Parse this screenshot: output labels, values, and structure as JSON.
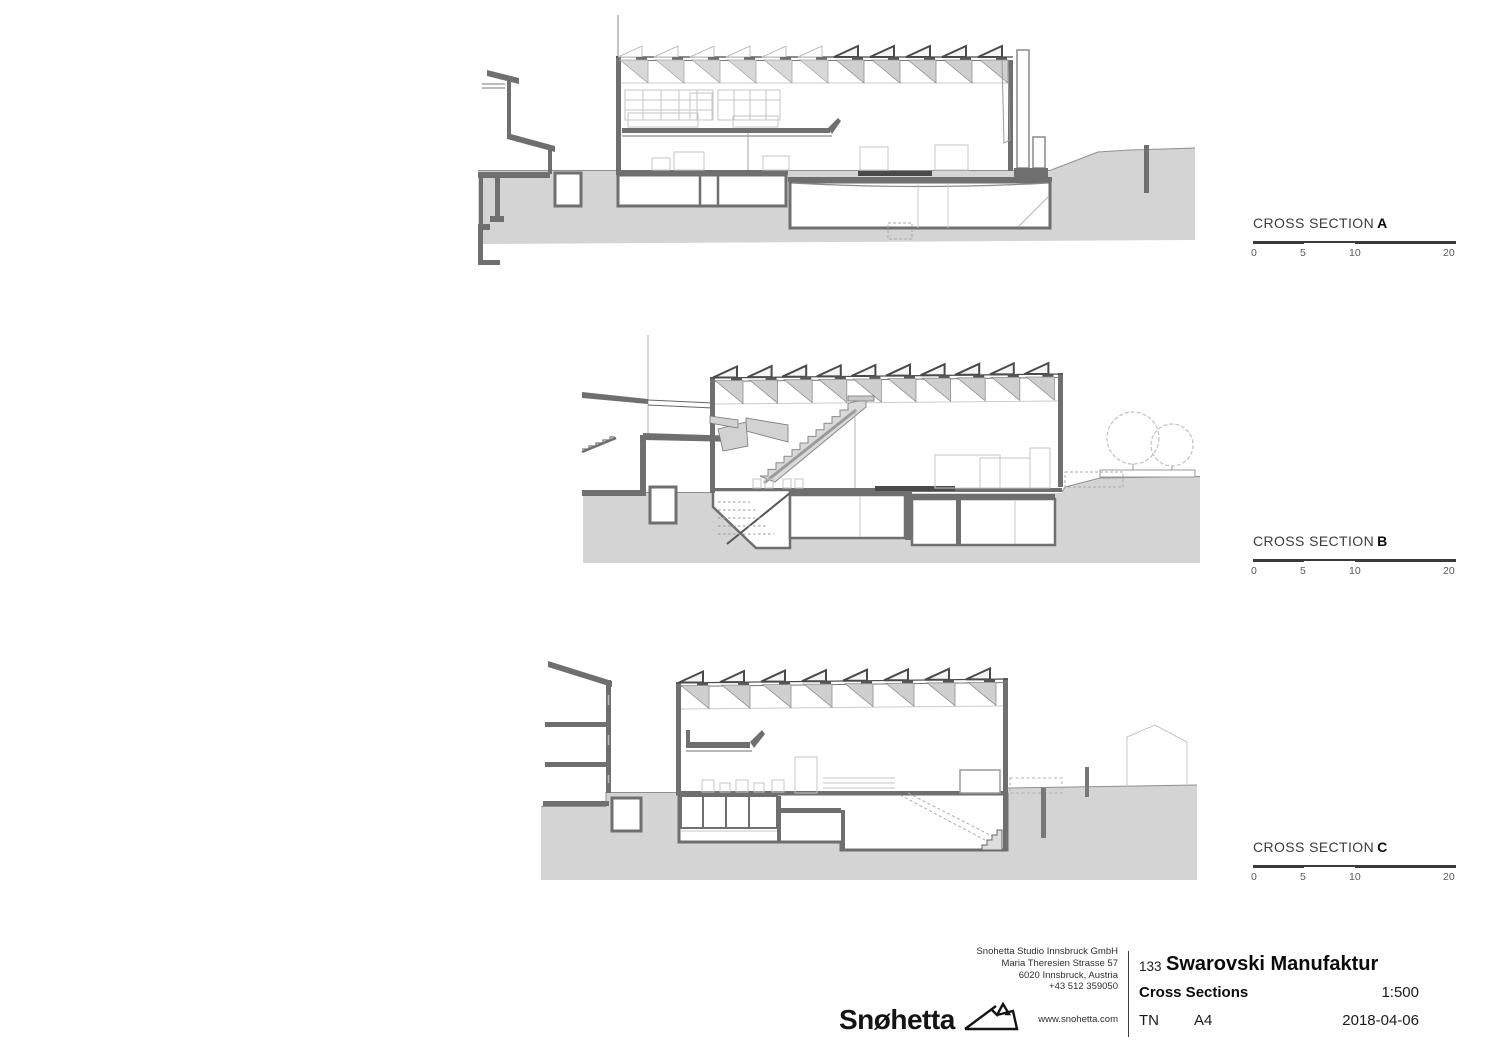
{
  "sections": [
    {
      "name": "CROSS SECTION",
      "letter": "A"
    },
    {
      "name": "CROSS SECTION",
      "letter": "B"
    },
    {
      "name": "CROSS SECTION",
      "letter": "C"
    }
  ],
  "scalebar": {
    "ticks": [
      "0",
      "5",
      "10",
      "20"
    ],
    "unit": "meters",
    "total": 20
  },
  "titleblock": {
    "logo_text": "Snøhetta",
    "address_lines": [
      "Snohetta Studio Innsbruck GmbH",
      "Maria Theresien Strasse 57",
      "6020 Innsbruck, Austria",
      "+43 512 359050"
    ],
    "website": "www.snohetta.com",
    "project_number": "133",
    "project_name": "Swarovski Manufaktur",
    "sheet_title": "Cross Sections",
    "scale": "1:500",
    "drawn_by": "TN",
    "paper_size": "A4",
    "date": "2018-04-06"
  },
  "colors": {
    "ground": "#d4d4d4",
    "section_wall": "#6f6f6f",
    "roof_shade": "#cfcfcf",
    "light_line": "#c0c0c0",
    "text_dark": "#1a1a1a"
  }
}
